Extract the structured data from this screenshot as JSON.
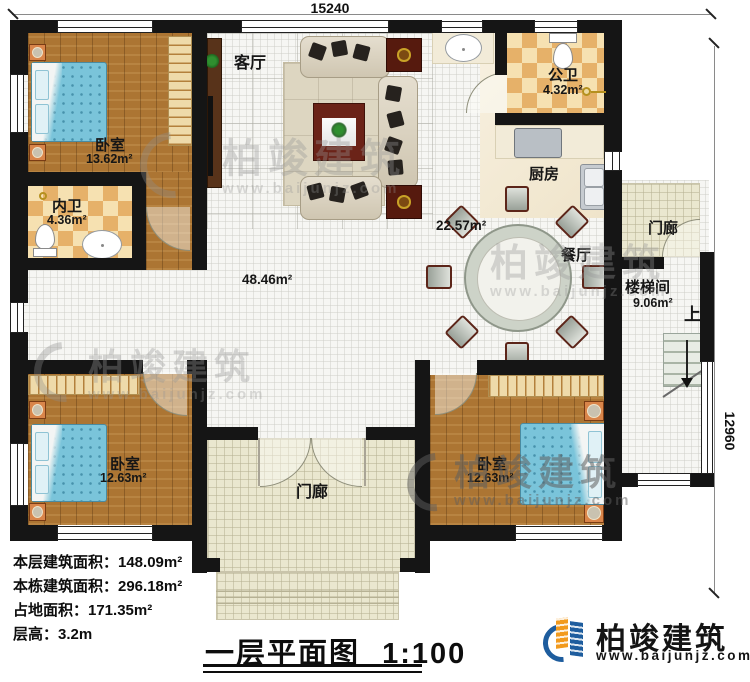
{
  "dimensions": {
    "top": "15240",
    "right": "12960"
  },
  "areas": {
    "hall": "48.46m²",
    "kitchen_dining": "22.57m²"
  },
  "rooms": {
    "bedroom1": {
      "name": "卧室",
      "area": "13.62m²"
    },
    "inner_bath": {
      "name": "内卫",
      "area": "4.36m²"
    },
    "living": {
      "name": "客厅"
    },
    "public_bath": {
      "name": "公卫",
      "area": "4.32m²"
    },
    "kitchen": {
      "name": "厨房"
    },
    "dining": {
      "name": "餐厅"
    },
    "stairwell": {
      "name": "楼梯间",
      "area": "9.06m²",
      "up": "上"
    },
    "porch_side": {
      "name": "门廊"
    },
    "porch_front": {
      "name": "门廊"
    },
    "bedroom_bl": {
      "name": "卧室",
      "area": "12.63m²"
    },
    "bedroom_br": {
      "name": "卧室",
      "area": "12.63m²"
    }
  },
  "stats": {
    "line1": "本层建筑面积：148.09m²",
    "line2": "本栋建筑面积：296.18m²",
    "line3": "占地面积：171.35m²",
    "line4": "层高：3.2m"
  },
  "title": {
    "text": "一层平面图",
    "scale": "1:100"
  },
  "brand": {
    "name": "柏竣建筑",
    "url": "www.baijunjz.com"
  },
  "watermark": {
    "text": "柏竣建筑",
    "url": "www.baijunjz.com"
  }
}
